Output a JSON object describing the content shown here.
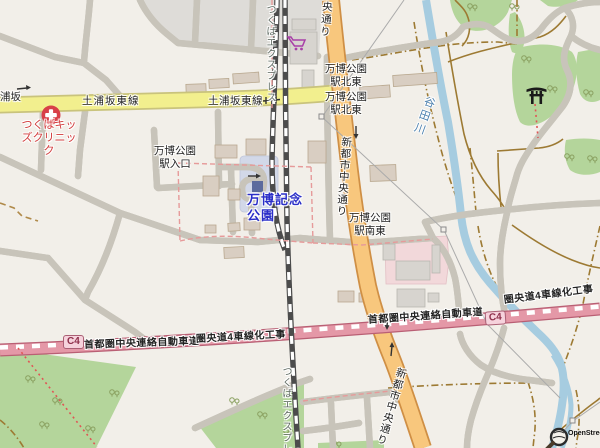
{
  "map": {
    "attribution": "OpenStreetMap",
    "labels": {
      "partial_road": "浦坂",
      "tsuchiura_left": "土浦坂東線",
      "tsuchiura_right": "土浦坂東線",
      "tx_top": "つくばエクスプレス",
      "tx_bottom": "つくばエクスプレ",
      "chuo_top": "中央通り",
      "shin_mid": "新都市中央通り",
      "shin_bottom": "新都市中央通り",
      "expo_ne1": "万博公園\n駅北東",
      "expo_ne2": "万博公園\n駅北東",
      "expo_entrance": "万博公園\n駅入口",
      "expo_station": "万博記念\n公園",
      "expo_se": "万博公園\n駅南東",
      "yatagawa": "谷田川",
      "clinic": "つくばキッ\nズクリニッ\nク",
      "c4_left": "C4",
      "c4_right": "C4",
      "kenodo_left": "首都圏中央連絡自動車道",
      "kenodo_right": "首都圏中央連絡自動車道",
      "construction_left": "圏央道4車線化工事",
      "construction_right": "圏央道4車線化工事"
    },
    "icons": {
      "clinic": "clinic-cross-icon",
      "supermarket": "supermarket-cart-icon",
      "shrine": "torii-icon",
      "station": "train-station-icon",
      "pylon": "power-pylon-icon",
      "osm_logo": "osm-magnifier-logo-icon",
      "tree": "tree-icon",
      "oneway": "oneway-arrow-icon"
    },
    "colors": {
      "background": "#f2efe9",
      "landuse_gray": "#dedcd8",
      "green": "#b4d59b",
      "hospital_pink": "#f2d8da",
      "station_plaza": "#d2d8e8",
      "road_yellow": "#f2ef8e",
      "road_orange": "#f8c77d",
      "expressway_pink": "#e498a7",
      "rail_dark": "#4c4c4c",
      "water_blue": "#a6cce0",
      "track_brown": "#9d7a33",
      "boundary_red": "#e69a9a",
      "park_label_blue": "#2b2fc8",
      "clinic_red": "#d23c3c",
      "cart_purple": "#a83fa8"
    }
  }
}
